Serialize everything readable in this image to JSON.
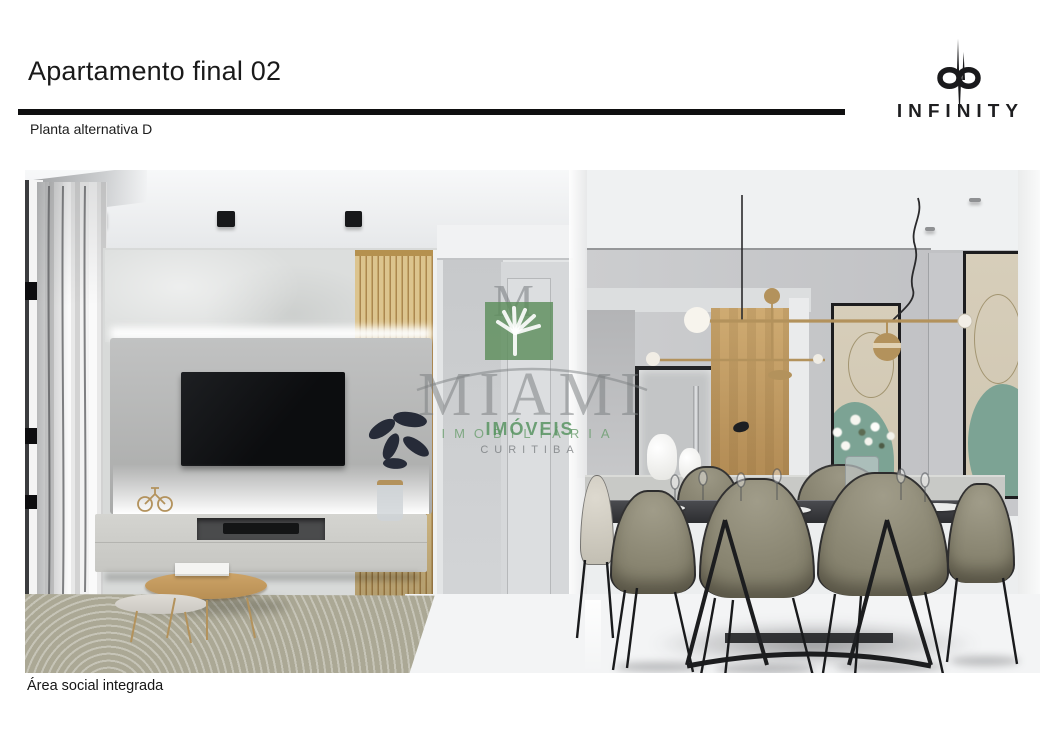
{
  "header": {
    "title": "Apartamento final 02",
    "subtitle": "Planta alternativa D",
    "brand": {
      "name": "INFINITY",
      "logo_icon": "dp-infinity-monogram-icon"
    }
  },
  "photo": {
    "caption": "Área social integrada",
    "alt": "3D render of the integrated social area: living room with TV wall, wood slat panel, rug and coffee tables on the left, hallway in the middle, dining table with olive chairs, pendant light and abstract art on the right",
    "watermark": {
      "brand": "MIAMI",
      "monogram": "M",
      "line_imobiliaria": "IMOBILIÁRIA",
      "line_imoveis": "IMÓVEIS",
      "line_city": "CURITIBA",
      "tree_icon": "palm-leaf-icon",
      "green": "#5d8e5c",
      "gray": "#87898c"
    },
    "palette": {
      "ceiling": "#f0f2f3",
      "wall_gray": "#c9cbcd",
      "wood_slats": "#d6bd85",
      "tv_black": "#141517",
      "console_gray": "#cfcfcb",
      "rug_beige": "#aba895",
      "chair_olive": "#8e8a76",
      "floor_white": "#f4f5f6",
      "brass": "#b3925c",
      "art_teal": "#7ca394"
    }
  }
}
